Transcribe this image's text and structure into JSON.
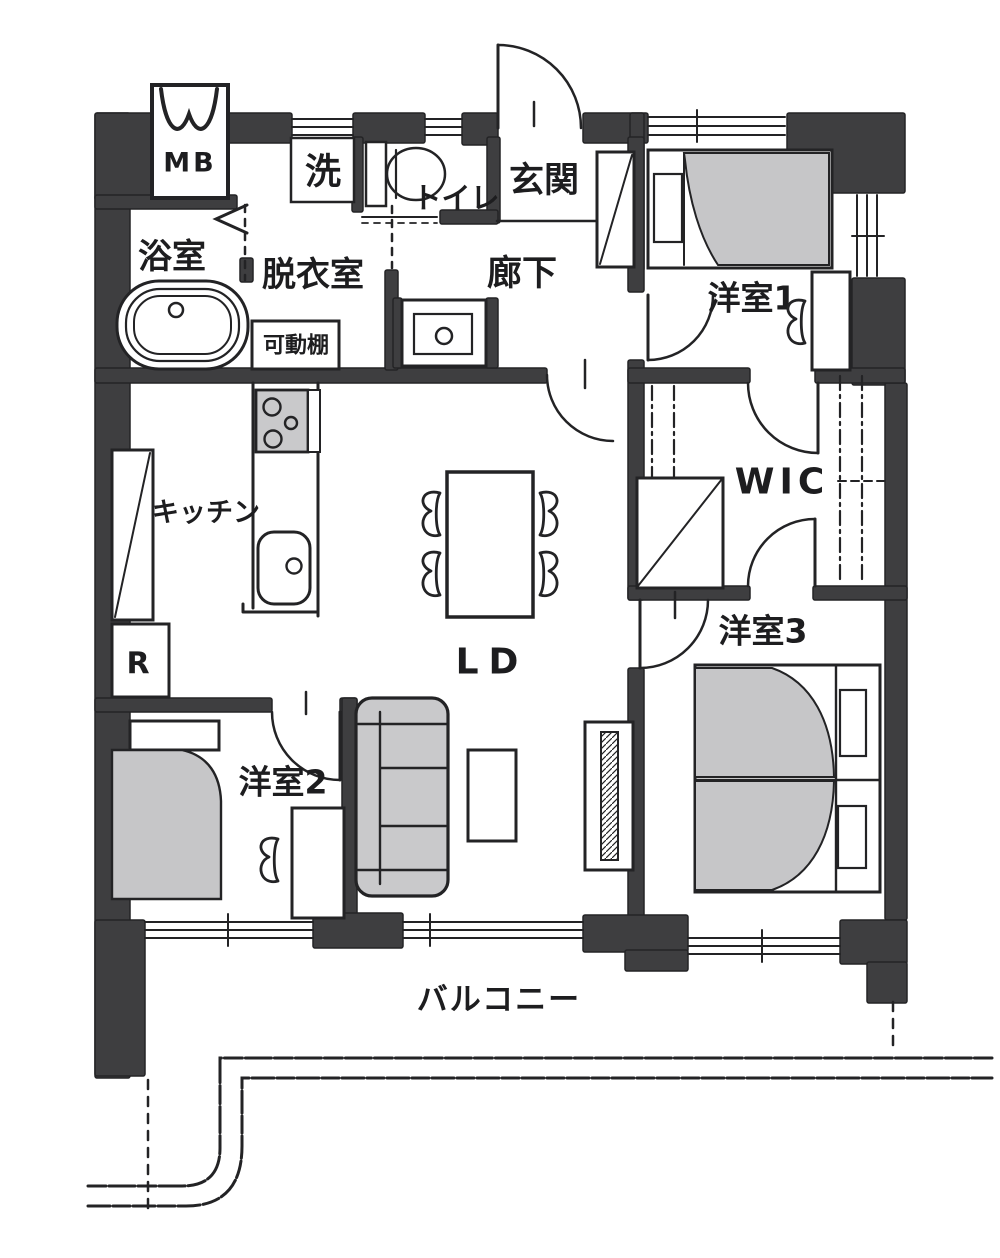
{
  "floorplan": {
    "colors": {
      "wall": "#3e3e40",
      "line": "#232325",
      "furniture": "#c9c9cb",
      "bed_fill": "#c6c6c8",
      "background": "#ffffff"
    },
    "rooms": {
      "mb": {
        "label": "MB"
      },
      "laundry": {
        "label": "洗"
      },
      "toilet": {
        "label": "トイレ"
      },
      "entrance": {
        "label": "玄関"
      },
      "bathroom": {
        "label": "浴室"
      },
      "dressing_room": {
        "label": "脱衣室"
      },
      "movable_shelf": {
        "label": "可動棚"
      },
      "hallway": {
        "label": "廊下"
      },
      "bedroom1": {
        "label": "洋室1"
      },
      "wic": {
        "label": "WIC"
      },
      "kitchen": {
        "label": "キッチン"
      },
      "refrigerator": {
        "label": "R"
      },
      "living_dining": {
        "label": "LD"
      },
      "bedroom2": {
        "label": "洋室2"
      },
      "bedroom3": {
        "label": "洋室3"
      },
      "balcony": {
        "label": "バルコニー"
      }
    }
  }
}
